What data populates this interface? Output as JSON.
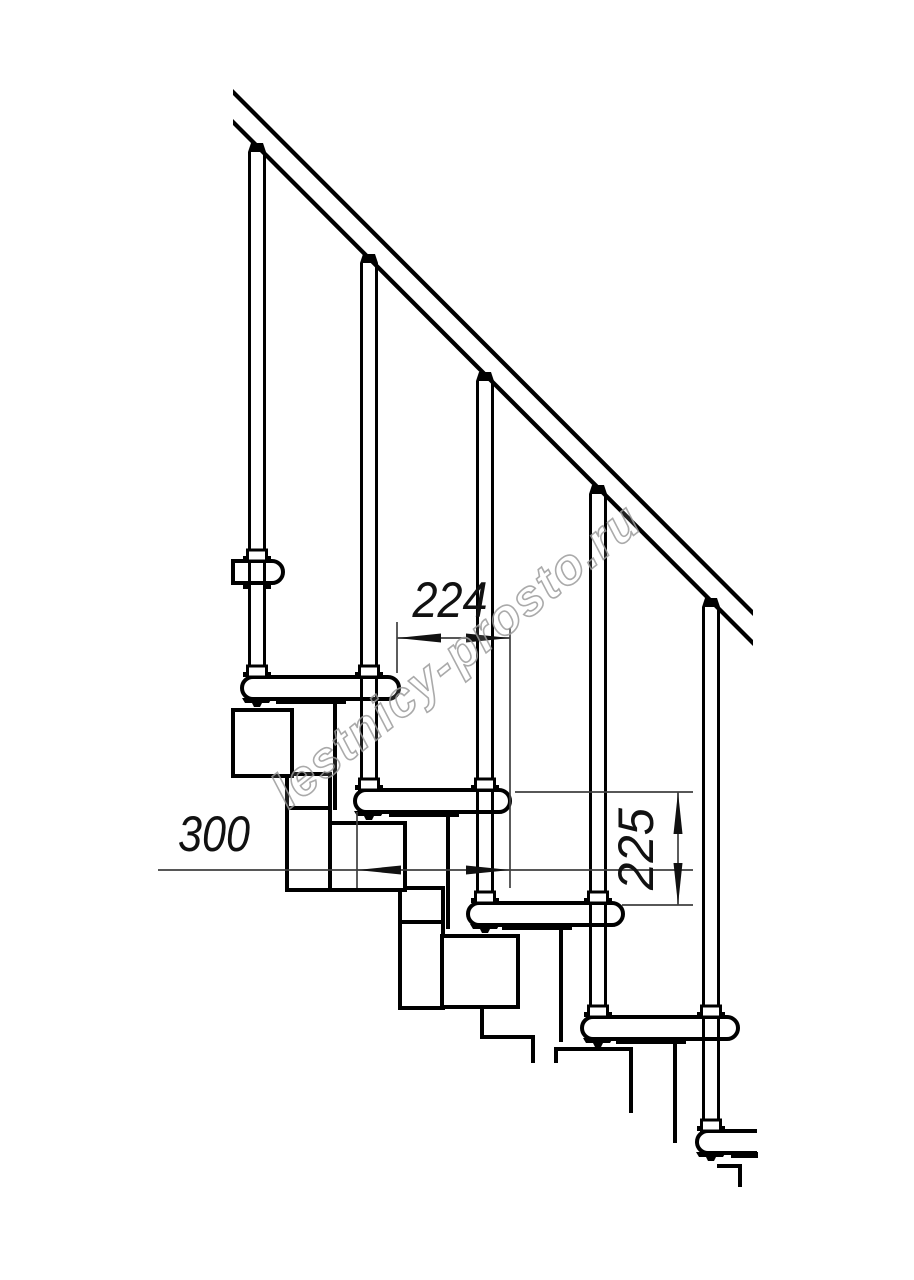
{
  "drawing": {
    "watermark": {
      "text": "lestnicy-prosto.ru",
      "color": "#9c9c9c"
    },
    "dimensions": {
      "step_run": {
        "label": "224"
      },
      "tread_depth": {
        "label": "300"
      },
      "step_rise": {
        "label": "225"
      }
    },
    "colors": {
      "line": "#000000",
      "dimension_line": "#3f3f3f",
      "background": "#ffffff"
    }
  }
}
